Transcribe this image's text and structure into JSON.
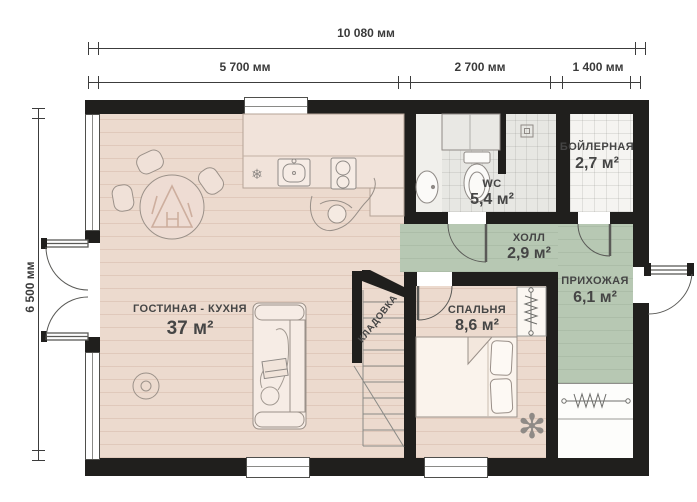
{
  "plan": {
    "title": "floor-plan",
    "dimensions": {
      "total_width": "10 080 мм",
      "total_height": "6 500 мм",
      "top_segments": [
        "5 700 мм",
        "2 700 мм",
        "1 400 мм"
      ]
    },
    "rooms": {
      "living_kitchen": {
        "name": "ГОСТИНАЯ - КУХНЯ",
        "area": "37 м²"
      },
      "wc": {
        "name": "WC",
        "area": "5,4 м²"
      },
      "boiler": {
        "name": "БОЙЛЕРНАЯ",
        "area": "2,7 м²"
      },
      "hall": {
        "name": "ХОЛЛ",
        "area": "2,9 м²"
      },
      "entry_hall": {
        "name": "ПРИХОЖАЯ",
        "area": "6,1 м²"
      },
      "bedroom": {
        "name": "СПАЛЬНЯ",
        "area": "8,6 м²"
      },
      "storage": {
        "name": "КЛАДОВКА"
      }
    },
    "icons": {
      "fridge": "❄",
      "plant": "✻"
    },
    "colors": {
      "wall": "#201f1d",
      "floor_wood": "#ecdace",
      "floor_green": "#b7c8b3",
      "tile_gray": "#e7e7e3",
      "tile_white": "#f5f4f1",
      "label_text": "#454545",
      "dimension_text": "#3a3a3a"
    }
  }
}
